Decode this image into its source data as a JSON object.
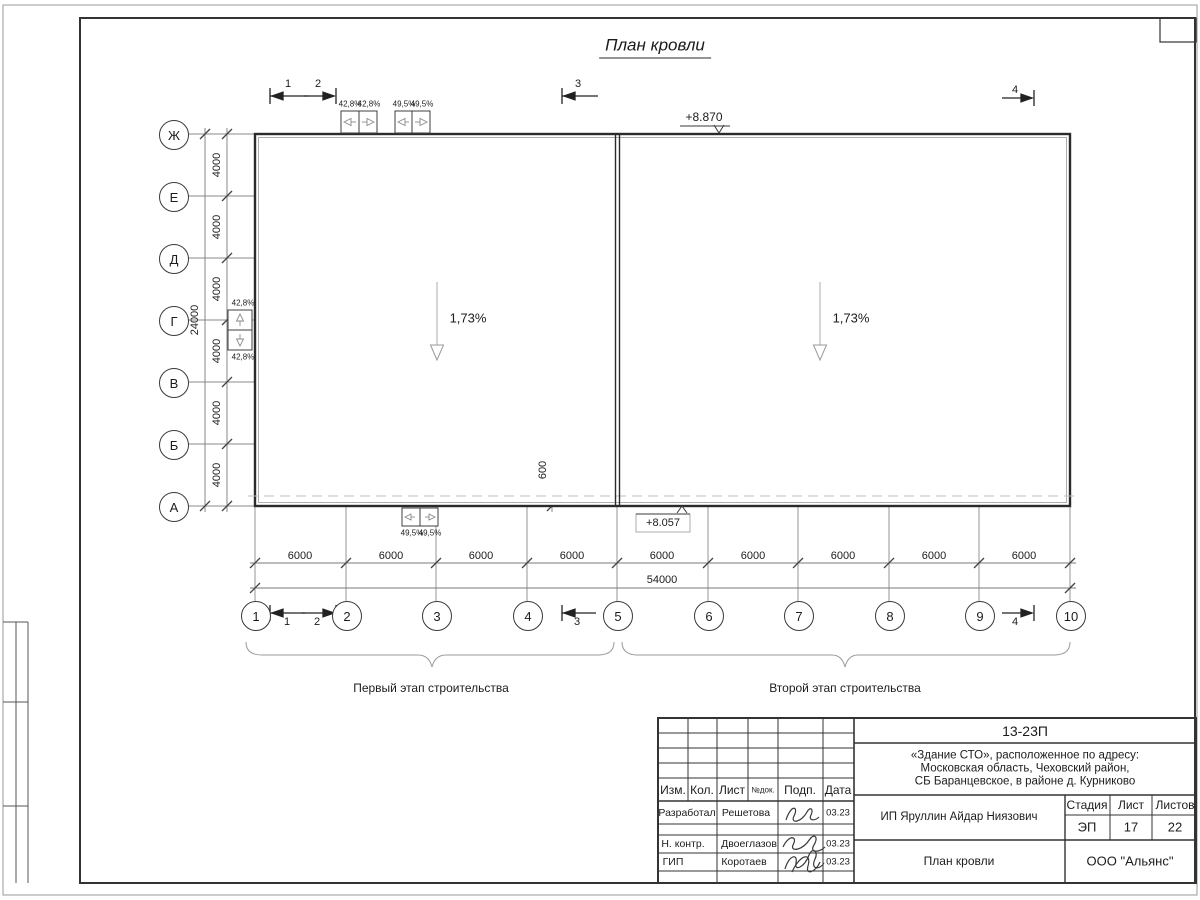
{
  "sheet": {
    "title": "План кровли",
    "stage1_label": "Первый этап строительства",
    "stage2_label": "Второй этап строительства"
  },
  "axes": {
    "rows": [
      "Ж",
      "Е",
      "Д",
      "Г",
      "В",
      "Б",
      "А"
    ],
    "cols": [
      "1",
      "2",
      "3",
      "4",
      "5",
      "6",
      "7",
      "8",
      "9",
      "10"
    ]
  },
  "dims": {
    "row_step": "4000",
    "row_total": "24000",
    "col_step": "6000",
    "col_total": "54000",
    "parapet": "600"
  },
  "marks": {
    "elev_top": "+8.870",
    "elev_bottom": "+8.057",
    "slope_left": "1,73%",
    "slope_right": "1,73%",
    "drain_a": "42,8%",
    "drain_b": "49,5%",
    "sections": [
      "1",
      "2",
      "3",
      "4"
    ]
  },
  "stamp": {
    "doc_number": "13-23П",
    "project_line1": "«Здание СТО», расположенное по адресу:",
    "project_line2": "Московская область, Чеховский район,",
    "project_line3": "СБ Баранцевское, в районе д. Курниково",
    "cols": {
      "izm": "Изм.",
      "kol": "Кол.",
      "list": "Лист",
      "ndoc": "№док.",
      "podp": "Подп.",
      "data": "Дата"
    },
    "rows": [
      {
        "role": "Разработал",
        "name": "Решетова",
        "date": "03.23"
      },
      {
        "role": "Н. контр.",
        "name": "Двоеглазов",
        "date": "03.23"
      },
      {
        "role": "ГИП",
        "name": "Коротаев",
        "date": "03.23"
      }
    ],
    "client": "ИП Яруллин Айдар Ниязович",
    "stage_label": "Стадия",
    "sheet_label": "Лист",
    "sheets_label": "Листов",
    "stage": "ЭП",
    "sheet_num": "17",
    "sheets_total": "22",
    "drawing_name": "План кровли",
    "company": "ООО \"Альянс\""
  }
}
